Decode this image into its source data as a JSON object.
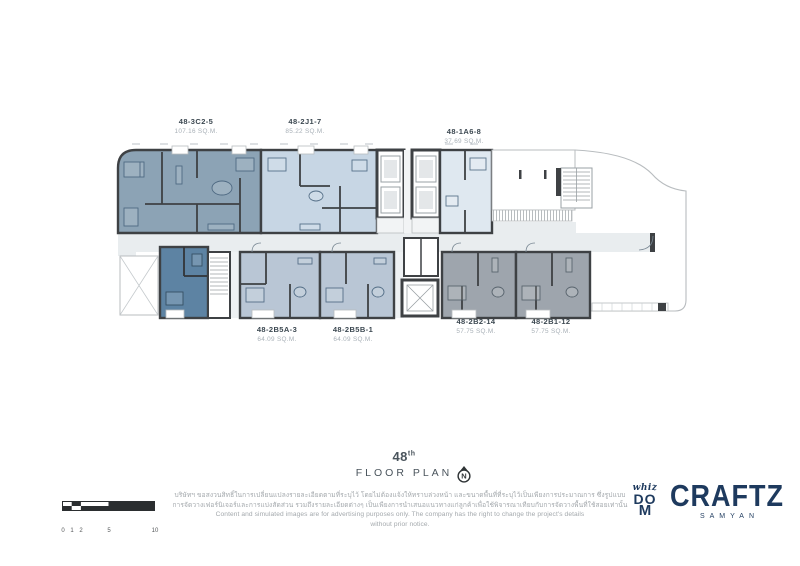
{
  "plan": {
    "units": [
      {
        "id": "48-3C2-5",
        "area": "107.16 SQ.M."
      },
      {
        "id": "48-2J1-7",
        "area": "85.22 SQ.M."
      },
      {
        "id": "48-1A6-8",
        "area": "37.69 SQ.M."
      },
      {
        "id": "48-2B5A-3",
        "area": "64.09 SQ.M."
      },
      {
        "id": "48-2B5B-1",
        "area": "64.09 SQ.M."
      },
      {
        "id": "48-2B2-14",
        "area": "57.75 SQ.M."
      },
      {
        "id": "48-2B1-12",
        "area": "57.75 SQ.M."
      }
    ]
  },
  "title": {
    "floor_number": "48",
    "ordinal": "th",
    "label": "FLOOR PLAN"
  },
  "compass": {
    "letter": "N"
  },
  "scale_bar": {
    "ticks": [
      "0",
      "1",
      "2",
      "5",
      "10"
    ]
  },
  "disclaimer": {
    "lines": [
      "บริษัทฯ ขอสงวนสิทธิ์ในการเปลี่ยนแปลงรายละเอียดตามที่ระบุไว้ โดยไม่ต้องแจ้งให้ทราบล่วงหน้า และขนาดพื้นที่ที่ระบุไว้เป็นเพียงการประมาณการ ซึ่งรูปแบบ",
      "การจัดวางเฟอร์นิเจอร์และการแบ่งสัดส่วน รวมถึงรายละเอียดต่างๆ เป็นเพียงการนำเสนอแนวทางแก่ลูกค้าเพื่อใช้พิจารณาเทียบกับการจัดวางพื้นที่ใช้สอยเท่านั้น",
      "Content and simulated images are for advertising purposes only. The company has the right to change the project's details",
      "without prior notice."
    ]
  },
  "brand": {
    "mark_top": "whiz",
    "mark_mid": "DO",
    "mark_bottom": "M",
    "name": "CRAFTZ",
    "subtitle": "SAMYAN",
    "navy": "#1e3a5e"
  },
  "colors": {
    "unit_3c2": "#8ca3b5",
    "unit_2j1": "#c7d6e4",
    "unit_1a6": "#dfe8f0",
    "unit_dark": "#5d83a3",
    "unit_2b5": "#b9c6d5",
    "unit_2b": "#9ea5ad",
    "walls": "#3e4144",
    "corridor": "#e9edef"
  }
}
